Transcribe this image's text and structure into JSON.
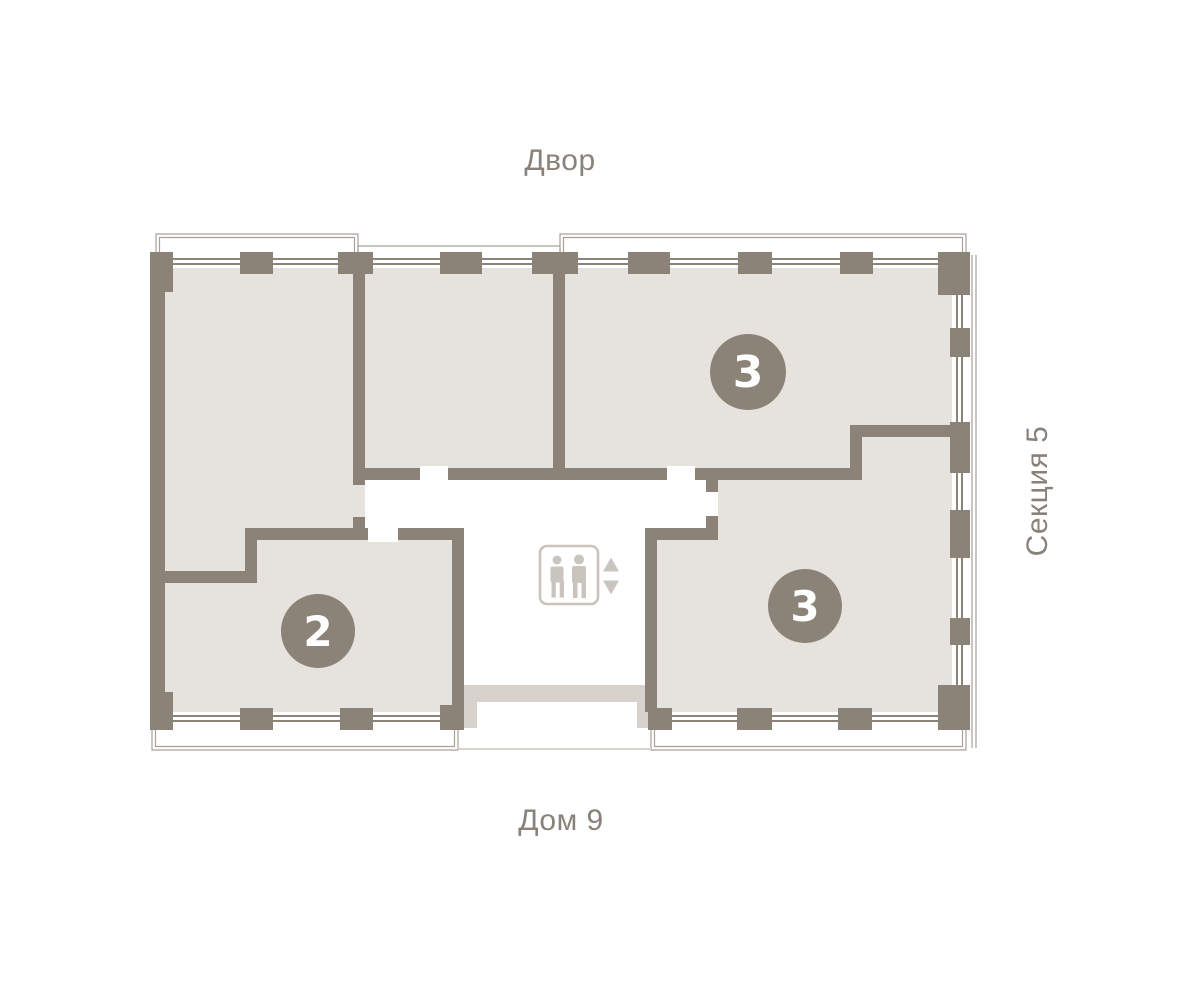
{
  "labels": {
    "courtyard": "Двор",
    "house": "Дом 9",
    "section": "Секция 5"
  },
  "apartments": [
    {
      "position": "top-right",
      "badge": "3"
    },
    {
      "position": "bottom-left",
      "badge": "2"
    },
    {
      "position": "bottom-right",
      "badge": "3"
    }
  ],
  "icons": {
    "elevator": "elevator-two-people-icon",
    "up_arrow": "up-arrow-icon",
    "down_arrow": "down-arrow-icon"
  },
  "colors": {
    "wall": "#8b8378",
    "room_fill": "#e6e2dd",
    "entrance_porch": "#d7d2cc",
    "balcony_outline": "#a8a198",
    "elevator_icon": "#c9c4be",
    "label_text": "#8a8279",
    "badge_background": "#8b8378",
    "badge_text": "#ffffff",
    "page_background": "#ffffff"
  }
}
